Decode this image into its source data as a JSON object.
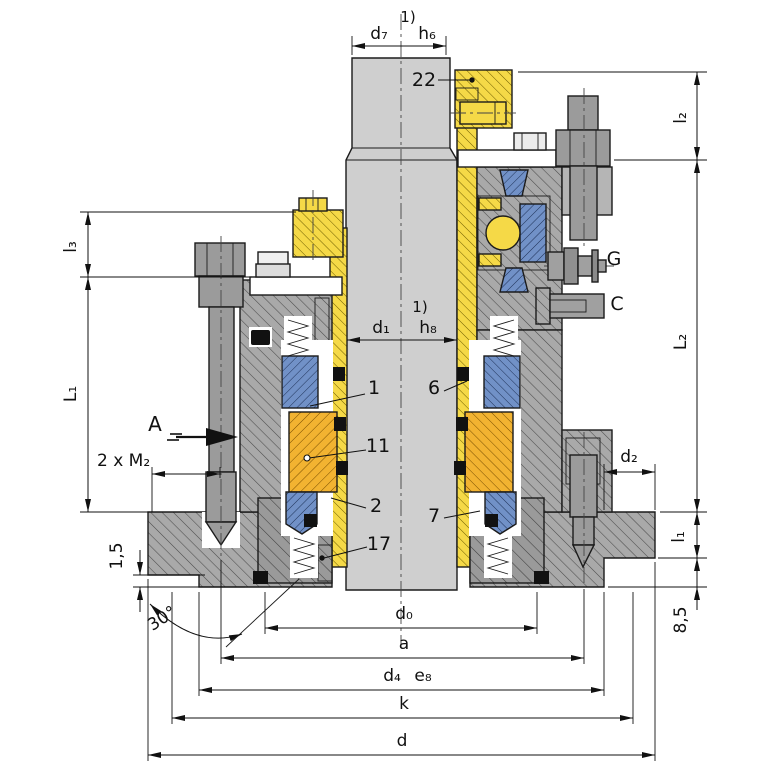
{
  "drawing_kind": "sectional technical drawing",
  "colors": {
    "sleeve_yellow": "#f5d947",
    "thrust_orange": "#f2b331",
    "seal_blue": "#7191c7",
    "housing_gray": "#a9a9a9",
    "gland_gray": "#9a9a9a",
    "shaft_gray": "#cfcfcf",
    "hardware_gray": "#9b9b9b",
    "line": "#1a1a1a",
    "background": "#ffffff"
  },
  "dimensions": {
    "top": {
      "footnote": "1)",
      "d7": "d₇",
      "h6": "h₆"
    },
    "shaft": {
      "footnote": "1)",
      "d1": "d₁",
      "h8": "h₈"
    },
    "bottom": {
      "d0": "d₀",
      "a": "a",
      "d4": "d₄",
      "e8": "e₈",
      "k": "k",
      "d": "d"
    },
    "left": {
      "l3": "l₃",
      "L1": "L₁",
      "m2": "2 x M₂",
      "chamfer": "1,5",
      "angle": "30°"
    },
    "right": {
      "l2": "l₂",
      "L2": "L₂",
      "d2": "d₂",
      "l1": "l₁",
      "step": "8,5"
    }
  },
  "parts": {
    "p1": "1",
    "p2": "2",
    "p6": "6",
    "p7": "7",
    "p11": "11",
    "p17": "17",
    "p22": "22"
  },
  "views": {
    "section_a": "A",
    "conn_g": "G",
    "conn_c": "C"
  }
}
